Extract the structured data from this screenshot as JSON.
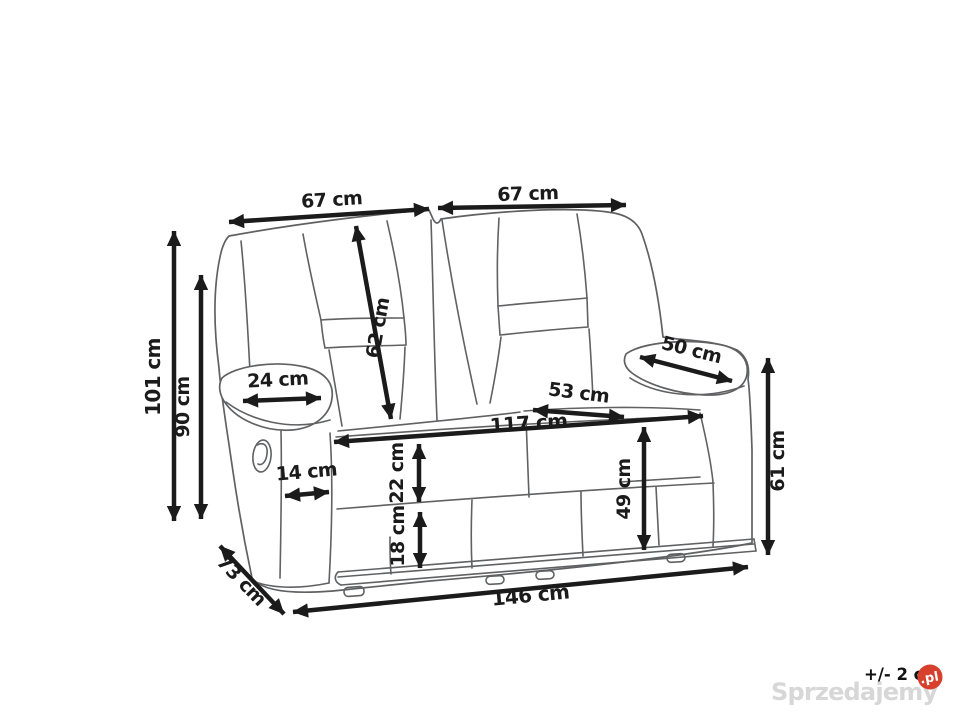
{
  "diagram": {
    "subject": "Two-seat recliner sofa dimension drawing",
    "unit": "cm",
    "dimensions": {
      "back_left_width": "67 cm",
      "back_right_width": "67 cm",
      "total_height": "101 cm",
      "backrest_height": "90 cm",
      "backrest_diagonal": "62 cm",
      "left_armrest_width": "24 cm",
      "right_armrest_depth": "50 cm",
      "seat_depth": "53 cm",
      "inner_width": "117 cm",
      "armrest_front_width": "14 cm",
      "front_upper_panel": "22 cm",
      "front_lower_panel": "18 cm",
      "seat_height": "49 cm",
      "armrest_height": "61 cm",
      "total_depth": "73 cm",
      "total_width": "146 cm"
    }
  },
  "watermark": {
    "tolerance_note": "+/- 2 c",
    "brand": "Sprzedajemy",
    "badge": ".pl"
  },
  "colors": {
    "dimension_ink": "#1b1b1b",
    "sofa_line": "#606163",
    "badge_red": "#d6402d",
    "watermark_gray": "#d7d7d7"
  }
}
